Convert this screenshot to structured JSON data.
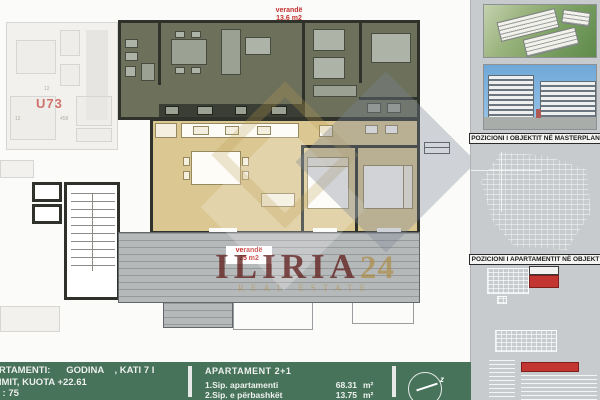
{
  "plan": {
    "unit_label": "U73",
    "verande_top": {
      "line1": "verandë",
      "line2": "13.6 m2"
    },
    "verande_bottom": {
      "line1": "verandë",
      "line2": "35 m2"
    },
    "dims": [
      "12",
      "12",
      "458"
    ]
  },
  "watermark": {
    "brand": "ILIRIA",
    "suffix": "24",
    "tagline": "REAL ESTATE"
  },
  "sidebar": {
    "caption_masterplan": "POZICIONI I OBJEKTIT NË MASTERPLAN",
    "caption_apartment": "POZICIONI I APARTAMENTIT NË OBJEKT"
  },
  "footer": {
    "left": {
      "line1": "ARTAMENTI:      GODINA    , KATI 7 I",
      "line2": "NIMIT, KUOTA +22.61",
      "line3": " 1 : 75"
    },
    "apartment": {
      "title": "APARTAMENT  2+1",
      "rows": [
        {
          "label": "1.Sip. apartamenti",
          "value": "68.31",
          "unit": "m²"
        },
        {
          "label": "2.Sip. e përbashkët",
          "value": "13.75",
          "unit": "m²"
        }
      ]
    },
    "compass_label": "z"
  },
  "colors": {
    "upper_apartment": "#6d705a",
    "lower_apartment": "#dac792",
    "terrace": "#b6b9ba",
    "footer_green": "#48735b",
    "accent_red": "#c23230",
    "watermark_maroon": "#61211f",
    "watermark_gold": "#ad8634"
  }
}
